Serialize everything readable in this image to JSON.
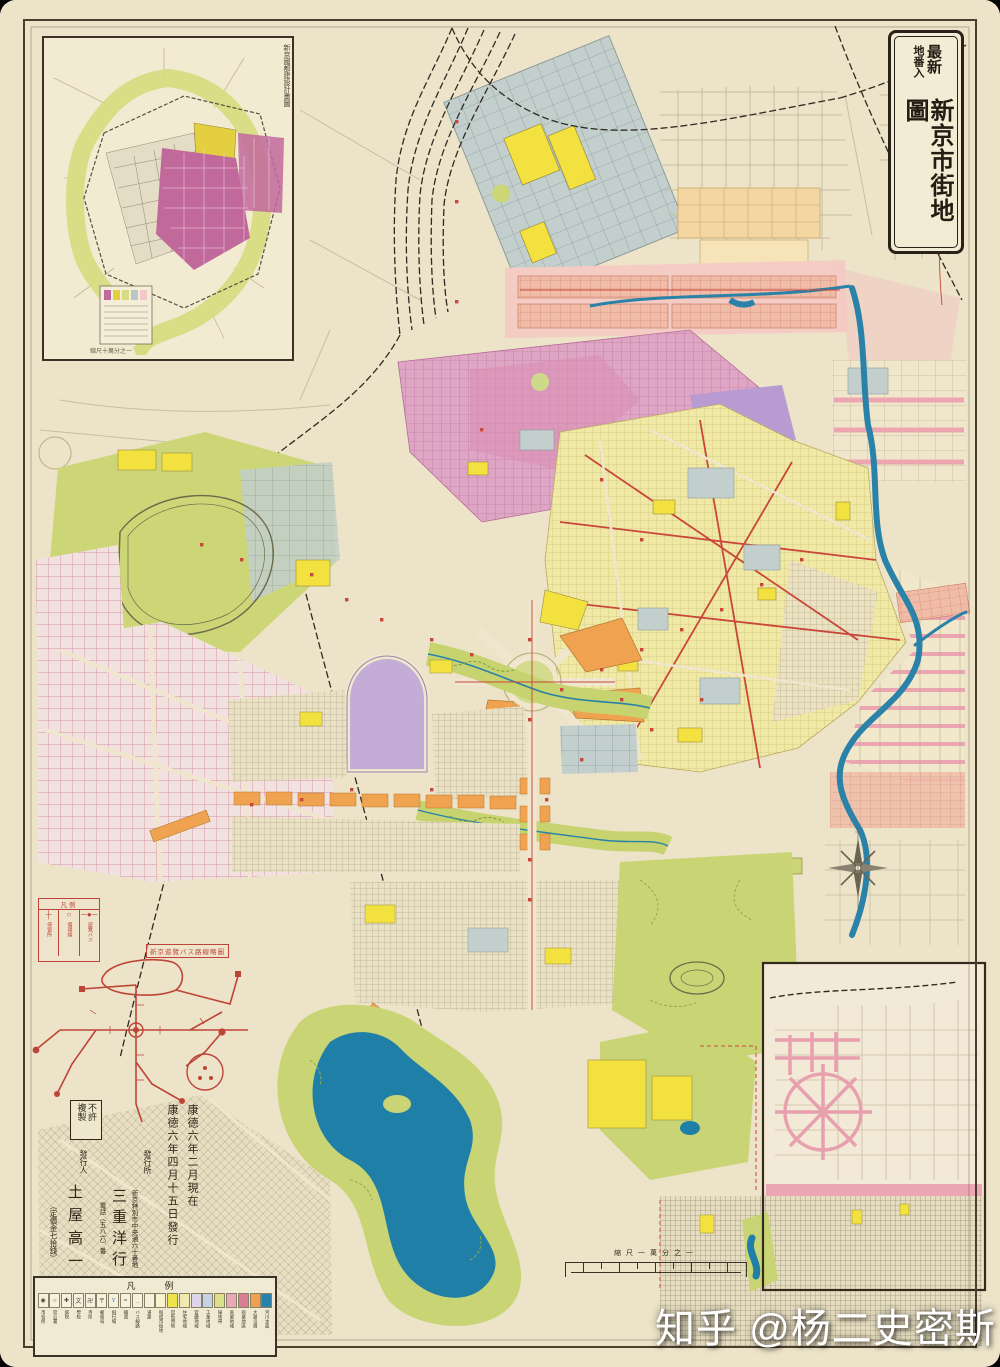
{
  "palette": {
    "paper": "#ece3c8",
    "water": "#2a82a8",
    "park_green": "#c9d575",
    "chartreuse": "#ccd677",
    "old_town_yellow": "#f0e9a6",
    "magenta": "#dfa5c4",
    "pink_band": "#f4ccc4",
    "salmon": "#f0bca8",
    "lavender_palace": "#c3acd5",
    "purple": "#b79bd1",
    "gray_blue": "#c3cfcc",
    "orange": "#efa350",
    "highlight_yellow": "#f2e13e",
    "road_red": "#c9463a",
    "frame_ink": "#3a3127"
  },
  "title_box": {
    "small_top": "最新",
    "small_bottom": "地番入",
    "main": "新京市街地圖"
  },
  "inset_map": {
    "caption": "新京國都建設計畫圖",
    "footnote": "縮尺十萬分之一"
  },
  "publication": {
    "no_copy_right": "不許",
    "no_copy_left": "複製",
    "date_line1": "康德六年二月現在",
    "date_line2": "康德六年四月十五日發行",
    "publisher_label": "發行所",
    "publisher_address": "新京特別市中央通六十番地",
    "publisher_name": "三重洋行",
    "publisher_phone": "電話（五八六）番",
    "issuer_label": "發行人",
    "issuer_name": "土屋高一",
    "price": "（定價金七拾錢）"
  },
  "bus_diagram": {
    "title": "新京遊覽バス路線略圖",
    "legend_title": "凡例",
    "items": [
      {
        "symbol": "─●─",
        "label": "遊覽バス"
      },
      {
        "symbol": "○",
        "label": "循環線"
      },
      {
        "symbol": "┼",
        "label": "停留所"
      }
    ]
  },
  "scale_bar": {
    "label": "縮尺一萬分之一"
  },
  "legend": {
    "title": "凡　例",
    "items": [
      {
        "glyph": "◉",
        "color": "#f6f0dd",
        "label": "市役所"
      },
      {
        "glyph": "○",
        "color": "#f6f0dd",
        "label": "官公署"
      },
      {
        "glyph": "✚",
        "color": "#f6f0dd",
        "label": "病院"
      },
      {
        "glyph": "文",
        "color": "#f6f0dd",
        "label": "學校"
      },
      {
        "glyph": "卍",
        "color": "#f6f0dd",
        "label": "寺院"
      },
      {
        "glyph": "〒",
        "color": "#f6f0dd",
        "label": "郵便局"
      },
      {
        "glyph": "Y",
        "color": "#f6f0dd",
        "label": "飛行場"
      },
      {
        "glyph": "┅",
        "color": "#f6f0dd",
        "label": "鐵道"
      },
      {
        "glyph": "﹍",
        "color": "#f6f0dd",
        "label": "バス線路"
      },
      {
        "glyph": "",
        "color": "#f6f0dd",
        "label": "道路"
      },
      {
        "glyph": "",
        "color": "#f8f3cc",
        "label": "既成市街地"
      },
      {
        "glyph": "",
        "color": "#f0e34a",
        "label": "官衙用地"
      },
      {
        "glyph": "",
        "color": "#efe9b0",
        "label": "住宅地域"
      },
      {
        "glyph": "",
        "color": "#ddd6ea",
        "label": "官廳地域"
      },
      {
        "glyph": "",
        "color": "#c3d3e4",
        "label": "工業地域"
      },
      {
        "glyph": "",
        "color": "#dde08a",
        "label": "綠地帶"
      },
      {
        "glyph": "",
        "color": "#e8a8b8",
        "label": "商業地域"
      },
      {
        "glyph": "",
        "color": "#d97f93",
        "label": "商業地區"
      },
      {
        "glyph": "",
        "color": "#f0a050",
        "label": "大路沿線"
      },
      {
        "glyph": "",
        "color": "#2a82a8",
        "label": "河川水面"
      }
    ]
  },
  "watermark": {
    "text": "知乎 @杨二史密斯"
  }
}
